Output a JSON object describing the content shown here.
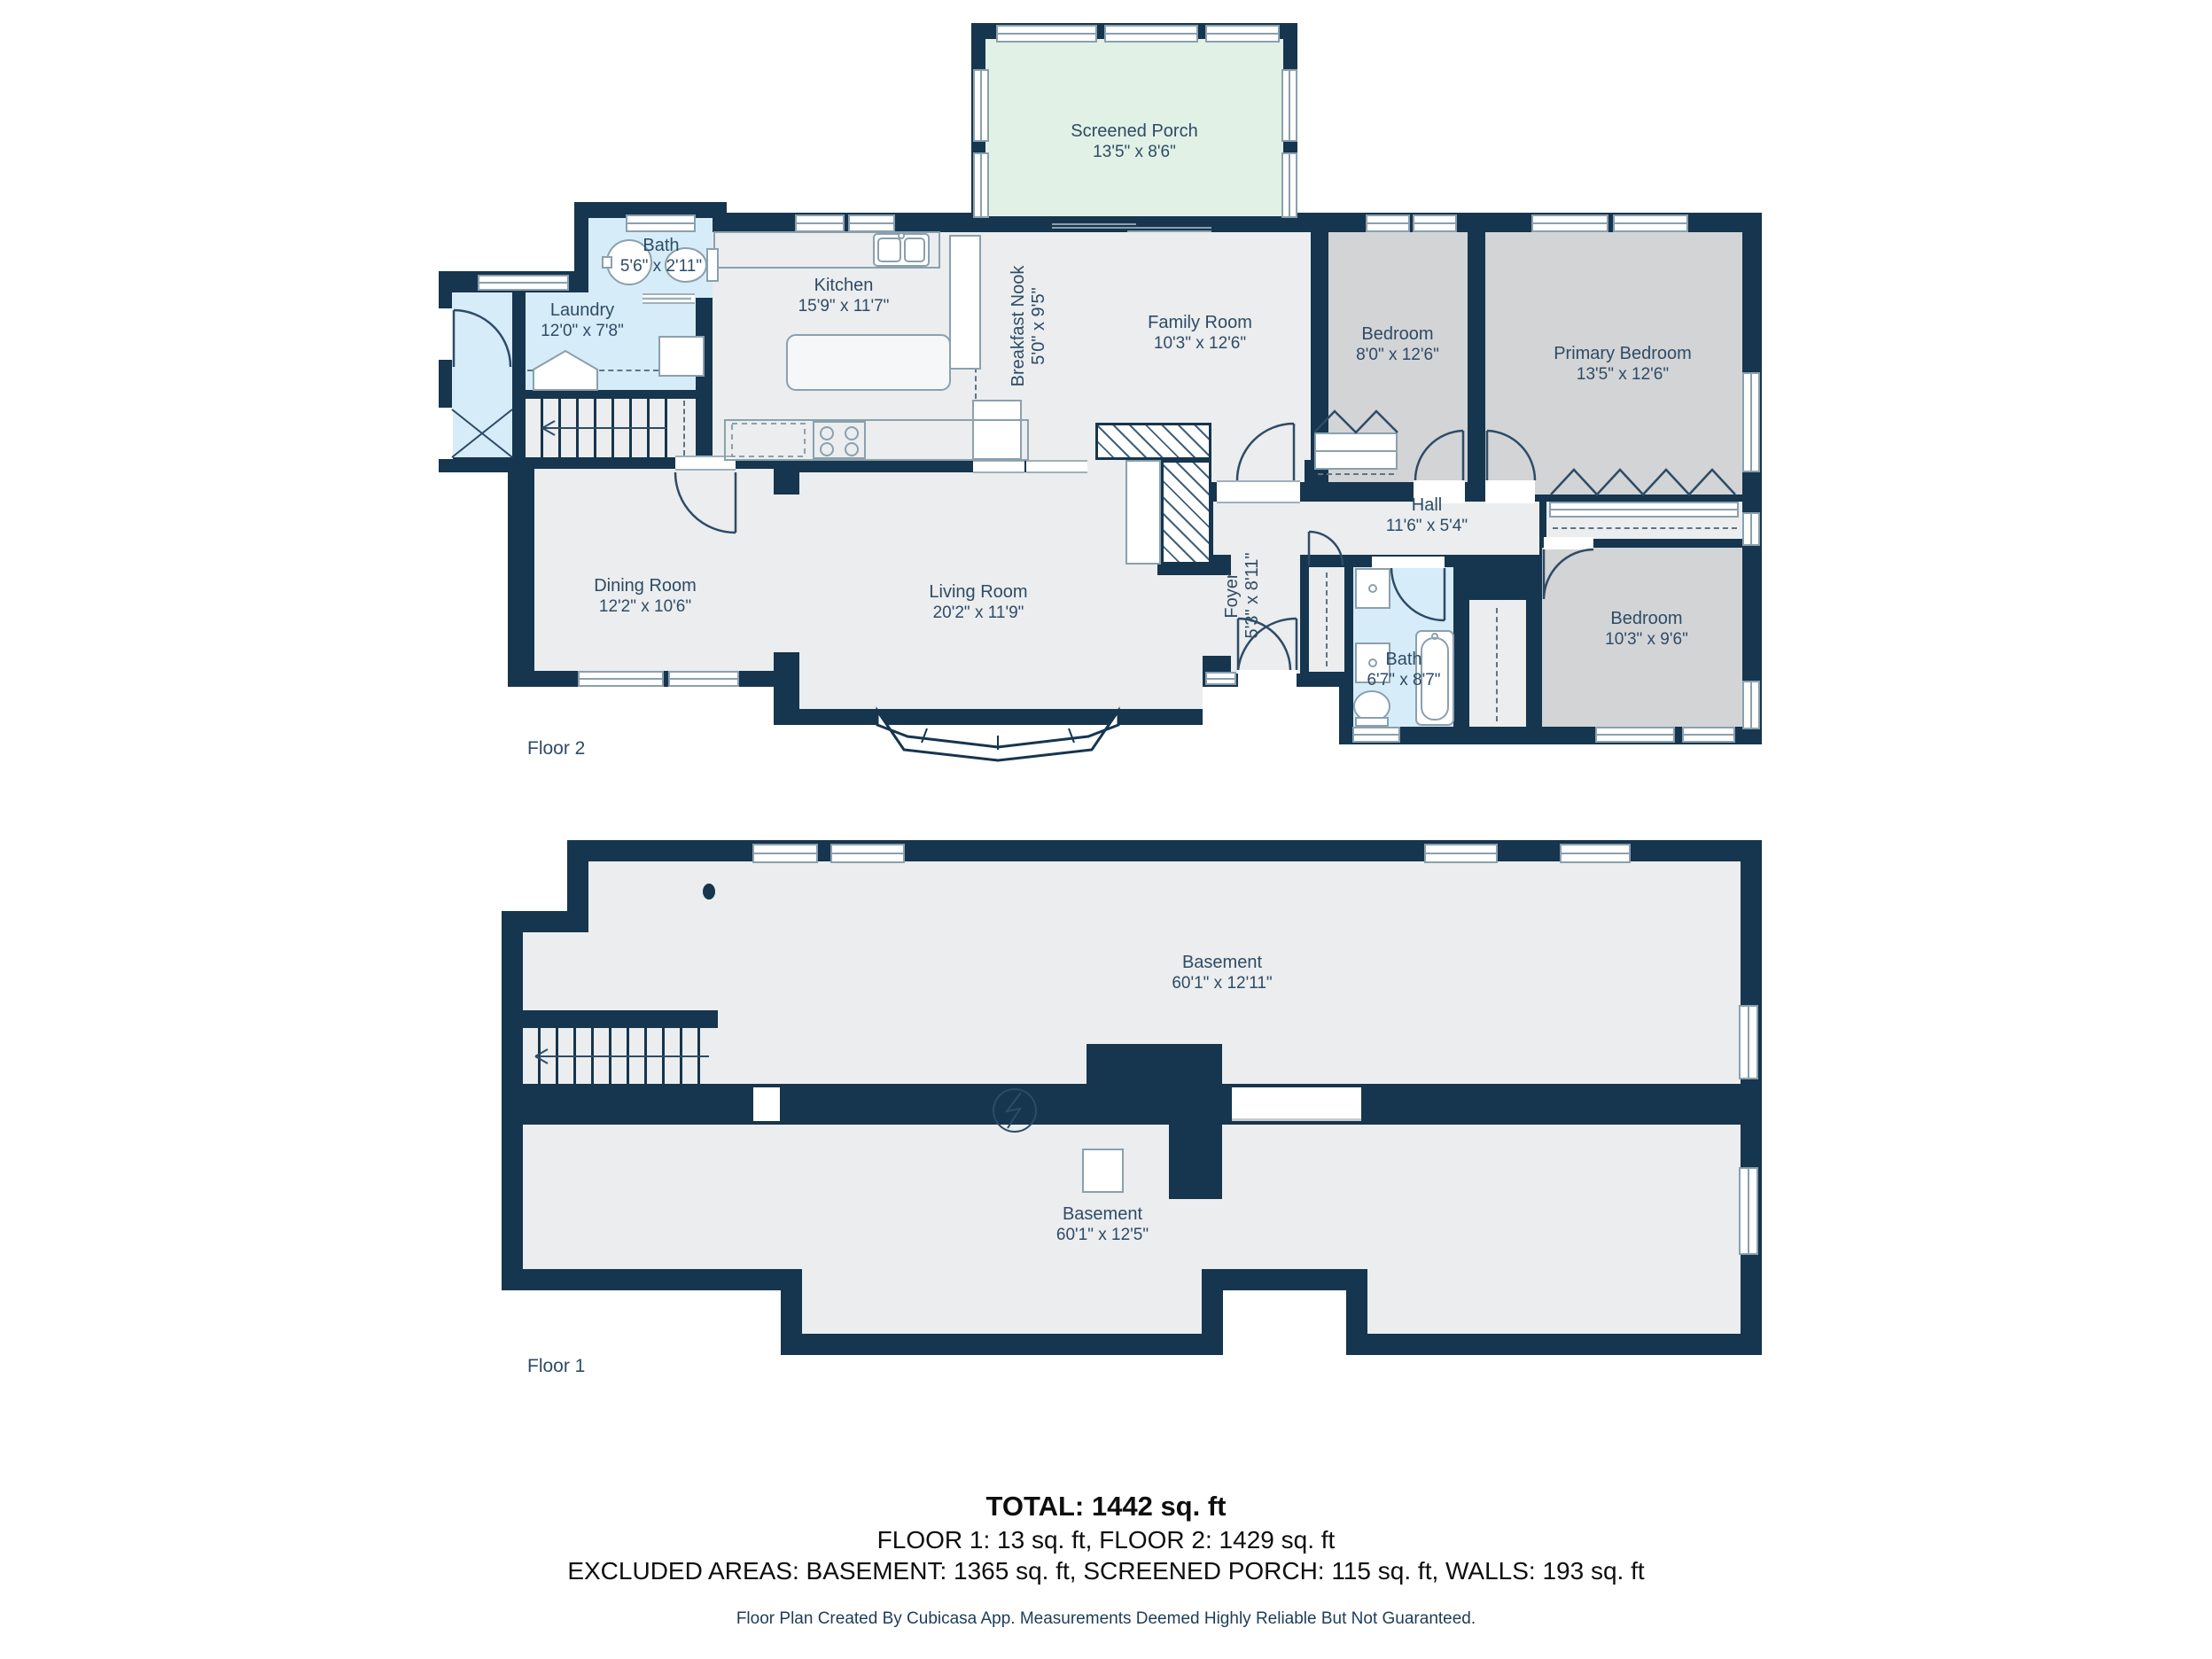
{
  "colors": {
    "wall_navy": "#16354e",
    "floor_gray": "#ebedee",
    "bedroom_gray": "#d2d4d6",
    "wet_blue": "#d6ecf8",
    "porch_green": "#e1f1e6",
    "label_text": "#2e4b66"
  },
  "floor2": {
    "label": "Floor 2",
    "rooms": [
      {
        "name": "Screened Porch",
        "dims": "13'5\" x 8'6\""
      },
      {
        "name": "Bath",
        "dims": "5'6\" x 2'11\""
      },
      {
        "name": "Laundry",
        "dims": "12'0\" x 7'8\""
      },
      {
        "name": "Kitchen",
        "dims": "15'9\" x 11'7\""
      },
      {
        "name": "Breakfast Nook",
        "dims": "5'0\" x 9'5\""
      },
      {
        "name": "Family Room",
        "dims": "10'3\" x 12'6\""
      },
      {
        "name": "Bedroom",
        "dims": "8'0\" x 12'6\""
      },
      {
        "name": "Primary Bedroom",
        "dims": "13'5\" x 12'6\""
      },
      {
        "name": "Hall",
        "dims": "11'6\" x 5'4\""
      },
      {
        "name": "Dining Room",
        "dims": "12'2\" x 10'6\""
      },
      {
        "name": "Living Room",
        "dims": "20'2\" x 11'9\""
      },
      {
        "name": "Foyer",
        "dims": "5'3\" x 8'11\""
      },
      {
        "name": "Bath",
        "dims": "6'7\" x 8'7\""
      },
      {
        "name": "Bedroom",
        "dims": "10'3\" x 9'6\""
      }
    ]
  },
  "floor1": {
    "label": "Floor 1",
    "rooms": [
      {
        "name": "Basement",
        "dims": "60'1\" x 12'11\""
      },
      {
        "name": "Basement",
        "dims": "60'1\" x 12'5\""
      }
    ]
  },
  "summary": {
    "total": "TOTAL: 1442 sq. ft",
    "floors": "FLOOR 1: 13 sq. ft, FLOOR 2: 1429 sq. ft",
    "excluded": "EXCLUDED AREAS: BASEMENT: 1365 sq. ft, SCREENED PORCH: 115 sq. ft, WALLS: 193 sq. ft"
  },
  "footer": {
    "credit": "Floor Plan Created By Cubicasa App. Measurements Deemed Highly Reliable But Not Guaranteed."
  }
}
